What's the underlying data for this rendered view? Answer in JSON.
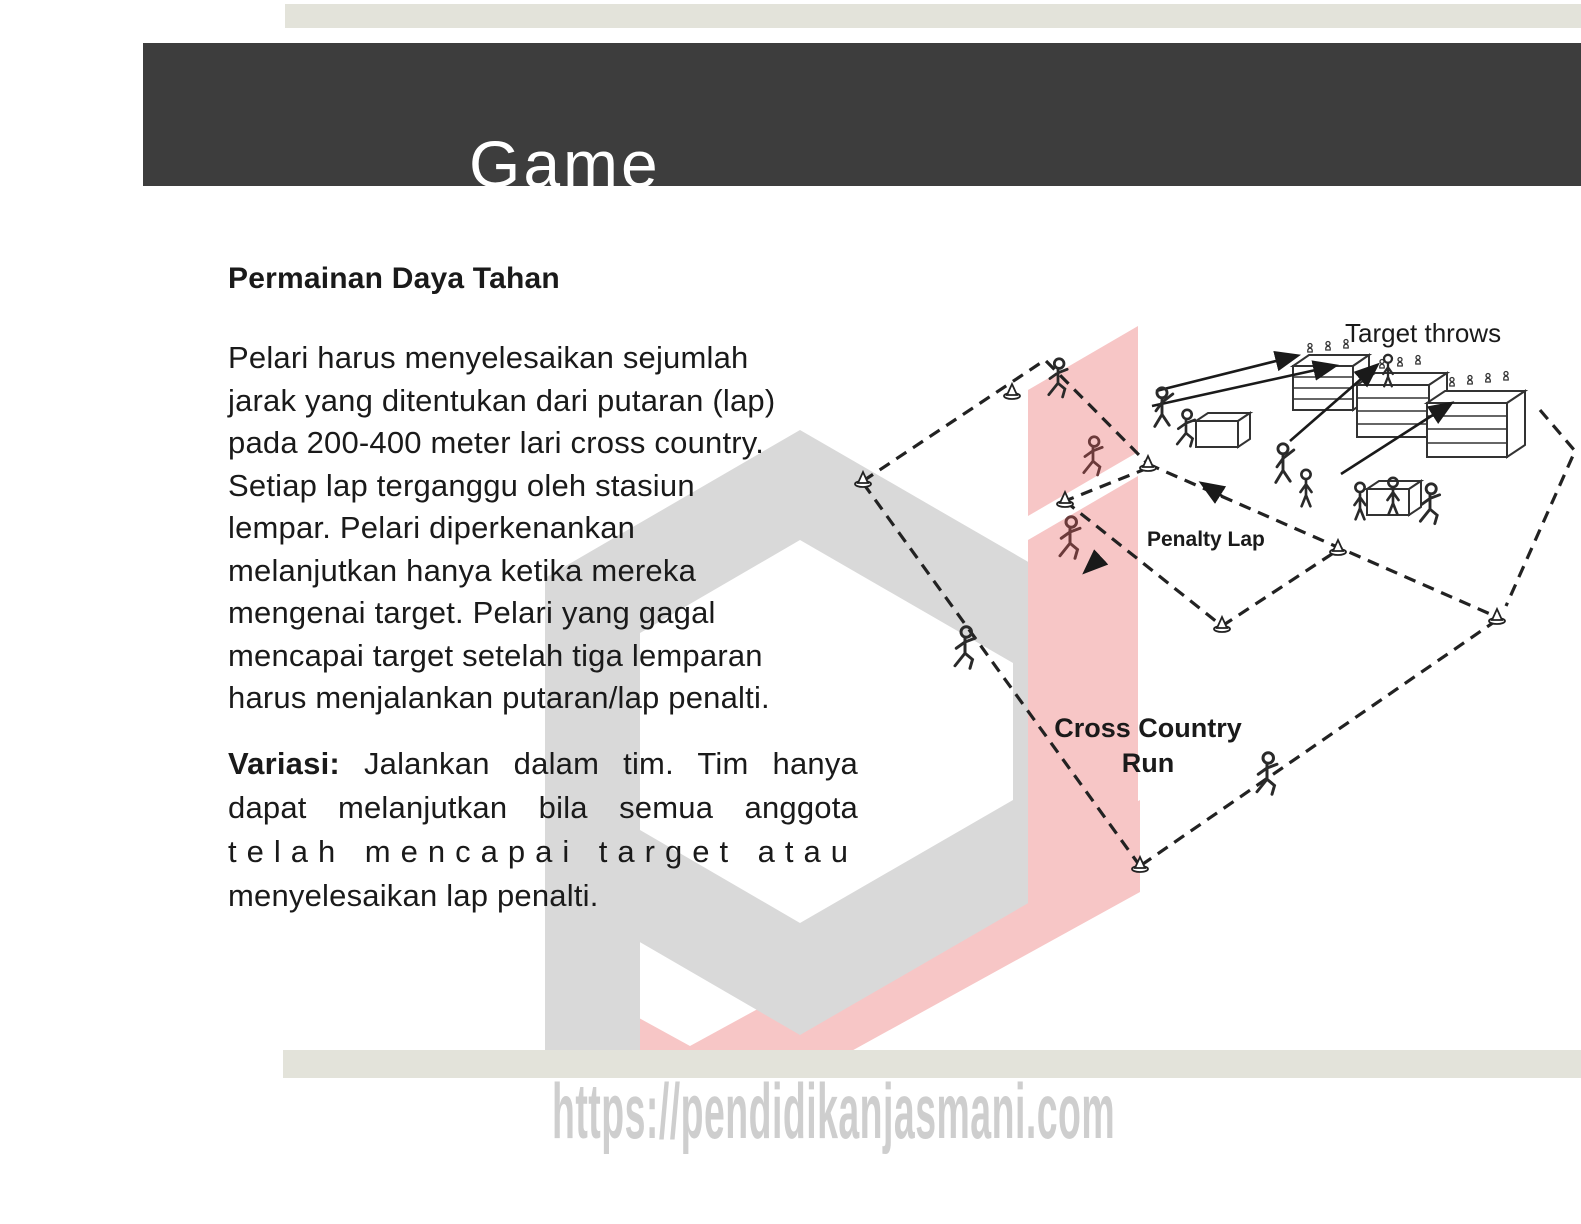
{
  "slide": {
    "title": "Game"
  },
  "content": {
    "heading": "Permainan Daya Tahan",
    "para1_lines": [
      "Pelari harus menyelesaikan sejumlah",
      "jarak yang ditentukan dari putaran (lap)",
      "pada 200-400 meter lari cross country.",
      "Setiap lap terganggu oleh stasiun",
      "lempar. Pelari diperkenankan",
      "melanjutkan hanya ketika mereka",
      "mengenai target. Pelari yang gagal",
      "mencapai target setelah tiga lemparan",
      "harus menjalankan putaran/lap penalti."
    ],
    "para2": {
      "bold": "Variasi:",
      "line1_rest": "Jalankan dalam tim. Tim hanya",
      "line2": "dapat melanjutkan bila semua anggota",
      "line3": "telah mencapai target atau",
      "line4": "menyelesaikan lap penalti."
    }
  },
  "diagram": {
    "labels": {
      "target_throws": "Target throws",
      "penalty_lap": "Penalty Lap",
      "cross_country_1": "Cross Country",
      "cross_country_2": "Run"
    }
  },
  "watermark": {
    "url": "https://pendidikanjasmani.com"
  },
  "colors": {
    "header_bg": "#3d3d3d",
    "strip": "#e3e3da",
    "logo_gray": "#d9d9d9",
    "logo_pink": "#f7c6c6",
    "ink": "#1a1a1a",
    "url_text": "#c9c9c9",
    "title_text": "#ffffff",
    "red_runner": "#6b3a3a"
  }
}
